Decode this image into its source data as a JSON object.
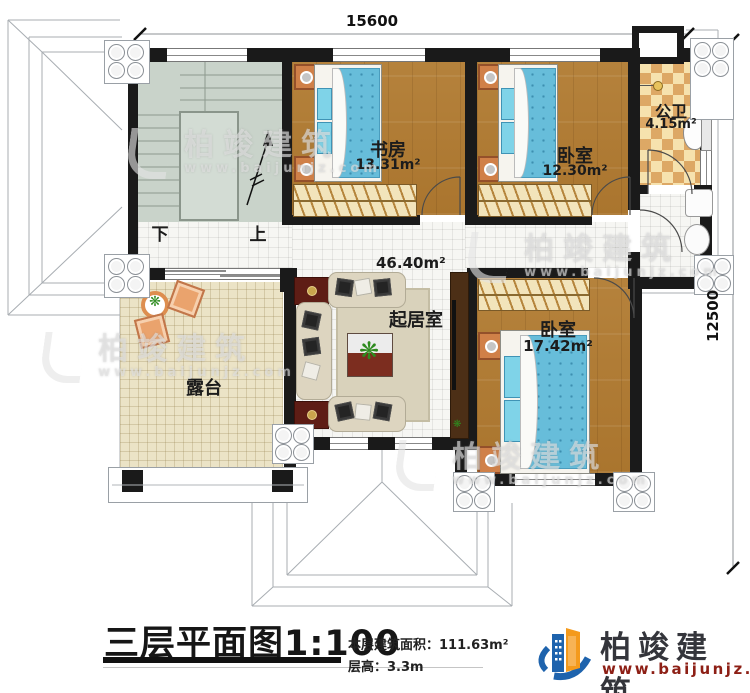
{
  "dimensions": {
    "top": "15600",
    "right": "12500"
  },
  "rooms": {
    "study": {
      "name": "书房",
      "area": "13.31m²"
    },
    "bedroom_top": {
      "name": "卧室",
      "area": "12.30m²"
    },
    "bathroom": {
      "name": "公卫",
      "area": "4.15m²"
    },
    "living": {
      "name": "起居室",
      "area": "46.40m²"
    },
    "bedroom_right": {
      "name": "卧室",
      "area": "17.42m²"
    },
    "terrace": {
      "name": "露台"
    }
  },
  "stairs": {
    "down": "下",
    "up": "上"
  },
  "title": {
    "main": "三层平面图",
    "scale": "1:100",
    "floor_area_label": "本层建筑面积：",
    "floor_area_value": "111.63m²",
    "floor_height_label": "层高：",
    "floor_height_value": "3.3m"
  },
  "brand": {
    "name": "柏竣建筑",
    "website": "www.baijunjz.com"
  },
  "watermark": {
    "text": "柏竣建筑",
    "url": "www.baijunjz.com"
  },
  "colors": {
    "wall": "#1a1a1a",
    "wood_floor": "#b5823c",
    "mattress_blue": "#67bdda",
    "bath_checker": "#dda865",
    "terrace_tile": "#ebe3c6",
    "stair_floor": "#c9d3ca",
    "logo_blue": "#1e63ad",
    "logo_orange": "#f49a1c",
    "logo_url_red": "#8d1f15"
  }
}
